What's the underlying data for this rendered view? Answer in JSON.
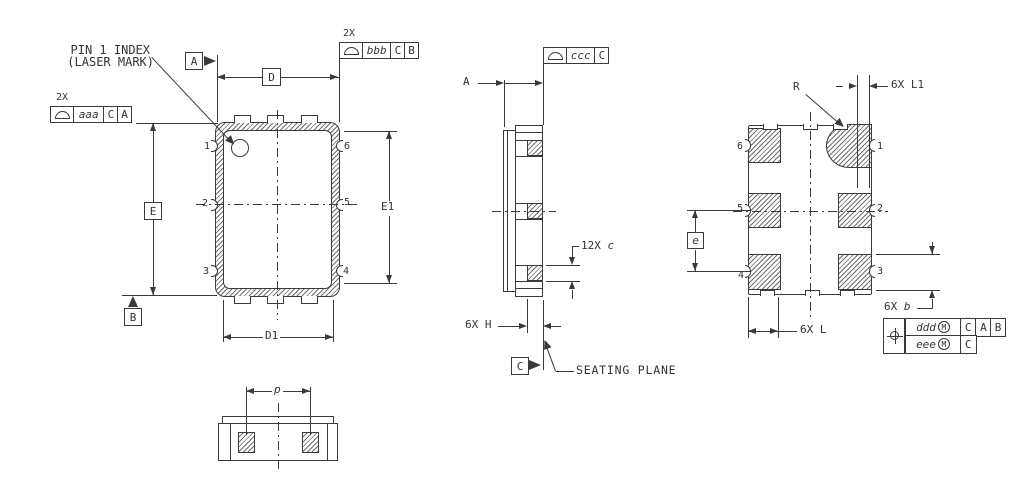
{
  "colors": {
    "line": "#3a3a3a",
    "text": "#333333",
    "background": "#ffffff"
  },
  "callouts": {
    "pin1_line1": "PIN 1 INDEX",
    "pin1_line2": "(LASER MARK)",
    "seating_plane": "SEATING PLANE"
  },
  "datums": {
    "a": "A",
    "b": "B",
    "c": "C"
  },
  "dims": {
    "D": "D",
    "D1": "D1",
    "E": "E",
    "E1": "E1",
    "A": "A",
    "p": "p",
    "e": "e",
    "R": "R",
    "c": {
      "qty": "12X",
      "letter": "c"
    },
    "H": {
      "qty": "6X",
      "letter": "H"
    },
    "L1": {
      "qty": "6X",
      "letter": "L1"
    },
    "b": {
      "qty": "6X",
      "letter": "b"
    },
    "L": {
      "qty": "6X",
      "letter": "L"
    }
  },
  "fcf": {
    "aaa": {
      "qty": "2X",
      "value": "aaa",
      "ref1": "C",
      "ref2": "A"
    },
    "bbb": {
      "qty": "2X",
      "value": "bbb",
      "ref1": "C",
      "ref2": "B"
    },
    "ccc": {
      "value": "ccc",
      "ref1": "C"
    },
    "position": {
      "row1": {
        "value": "ddd",
        "modifier": "M",
        "ref1": "C",
        "ref2": "A",
        "ref3": "B"
      },
      "row2": {
        "value": "eee",
        "modifier": "M",
        "ref1": "C"
      }
    }
  },
  "pins": {
    "n1": "1",
    "n2": "2",
    "n3": "3",
    "n4": "4",
    "n5": "5",
    "n6": "6"
  }
}
